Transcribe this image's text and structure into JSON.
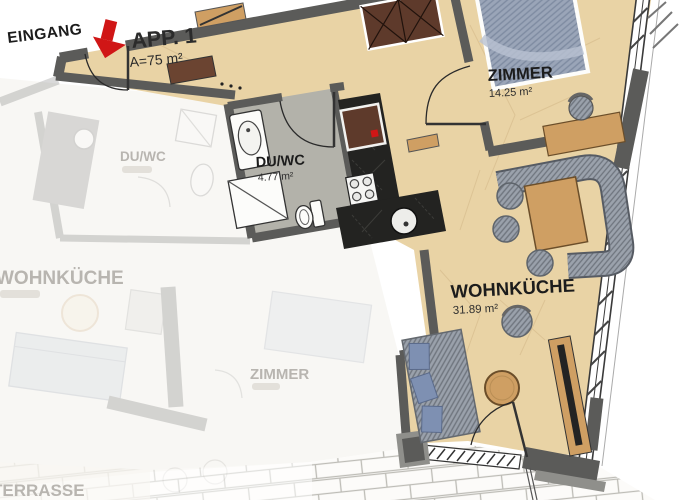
{
  "plan": {
    "entrance_label": "EINGANG",
    "unit": {
      "name": "APP. 1",
      "area": "A=75 m²"
    },
    "rooms": [
      {
        "name": "ZIMMER",
        "area": "14.25 m²"
      },
      {
        "name": "DU/WC",
        "area": "4.77 m²"
      },
      {
        "name": "WOHNKÜCHE",
        "area": "31.89 m²"
      }
    ],
    "adjacent_unit": {
      "rooms": [
        {
          "name": "DU/WC"
        },
        {
          "name": "WOHNKÜCHE"
        },
        {
          "name": "ZIMMER"
        },
        {
          "name": "TERRASSE"
        }
      ]
    }
  },
  "colors": {
    "wall": "#5b5b59",
    "floor": "#e9d3a5",
    "bath_floor": "#b3b2aa",
    "kitchen_counter": "#232321",
    "wood": "#cf9f63",
    "wardrobe_brown": "#5e3a2b",
    "upholstery": "#9aa1ab",
    "bed_blue": "#9aa5b8",
    "pillow_blue": "#7e90b2",
    "accent_red": "#d01616",
    "window": "#ffffff",
    "terrace_joint": "#bdbcb6",
    "faded": "#b8b5b0"
  }
}
